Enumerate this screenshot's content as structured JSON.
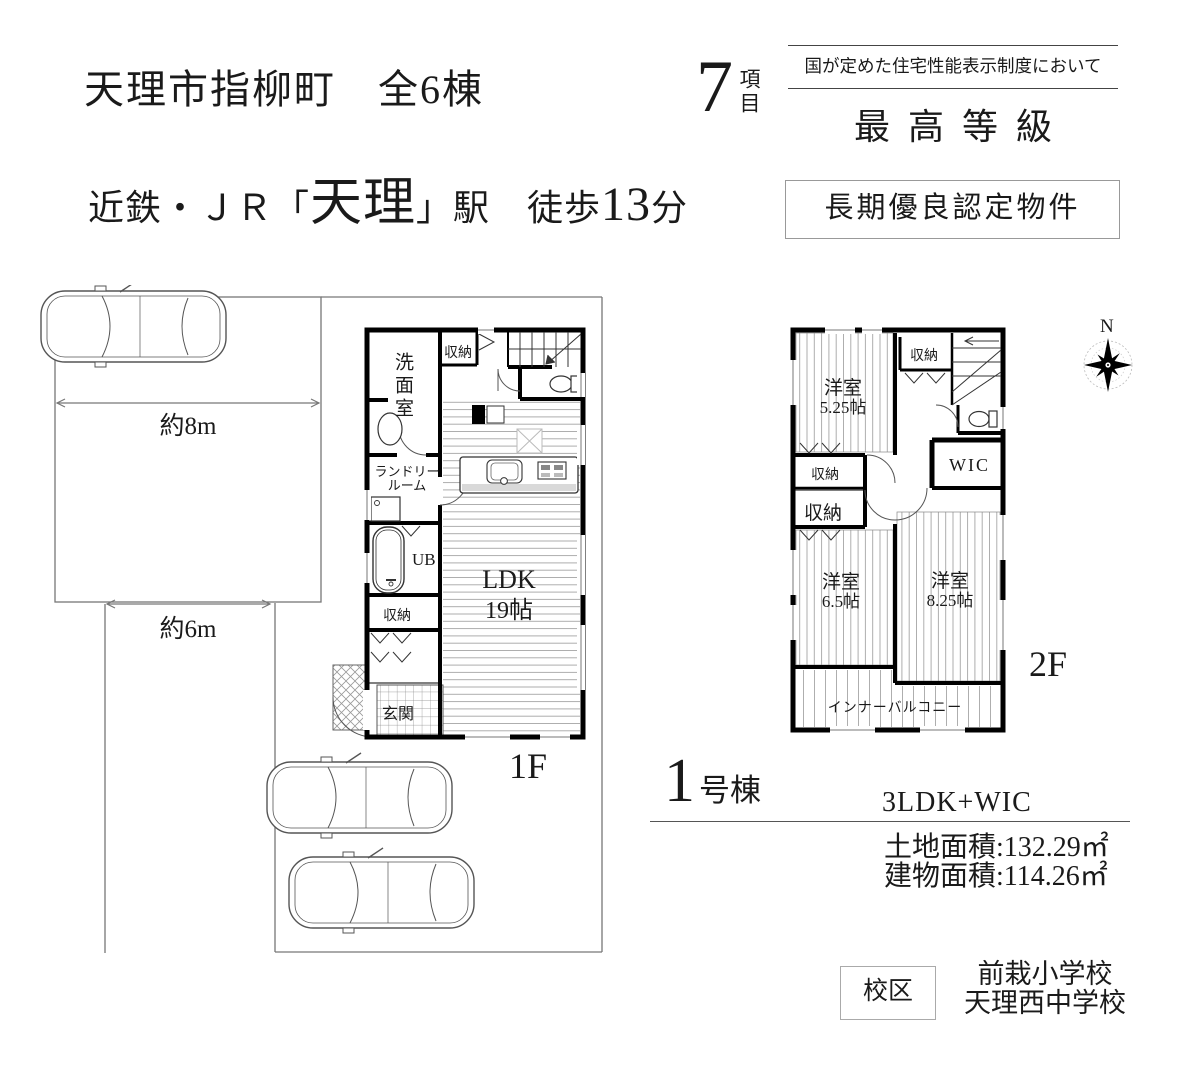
{
  "colors": {
    "ink": "#1a1a1a",
    "wall": "#000000",
    "site_line": "#777777"
  },
  "header": {
    "title": "天理市指柳町　全6棟",
    "access_prefix": "近鉄・ＪＲ「",
    "access_station": "天理",
    "access_mid": "」駅　徒歩",
    "access_minutes": "13",
    "access_suffix": "分"
  },
  "badge": {
    "count": "7",
    "count_unit": "項目",
    "subtitle": "国が定めた住宅性能表示制度において",
    "grade": "最高等級",
    "certification": "長期優良認定物件"
  },
  "site": {
    "dim_depth": "約8m",
    "dim_frontage": "約6m"
  },
  "floor1": {
    "label": "1F",
    "washroom": "洗面室",
    "storage_top": "収納",
    "laundry_line1": "ランドリー",
    "laundry_line2": "ルーム",
    "bath": "UB",
    "storage_left": "収納",
    "entrance": "玄関",
    "ldk_line1": "LDK",
    "ldk_line2": "19帖"
  },
  "floor2": {
    "label": "2F",
    "north": "N",
    "bedroom1_line1": "洋室",
    "bedroom1_line2": "5.25帖",
    "storage_top": "収納",
    "wic": "WIC",
    "storage_mid": "収納",
    "storage_low": "収納",
    "bedroom2_line1": "洋室",
    "bedroom2_line2": "6.5帖",
    "bedroom3_line1": "洋室",
    "bedroom3_line2": "8.25帖",
    "balcony": "インナーバルコニー"
  },
  "unit_info": {
    "number": "1",
    "number_suffix": "号棟",
    "layout": "3LDK+WIC",
    "land_area": "土地面積:132.29㎡",
    "building_area": "建物面積:114.26㎡"
  },
  "school_district": {
    "label": "校区",
    "elementary": "前栽小学校",
    "junior_high": "天理西中学校"
  }
}
